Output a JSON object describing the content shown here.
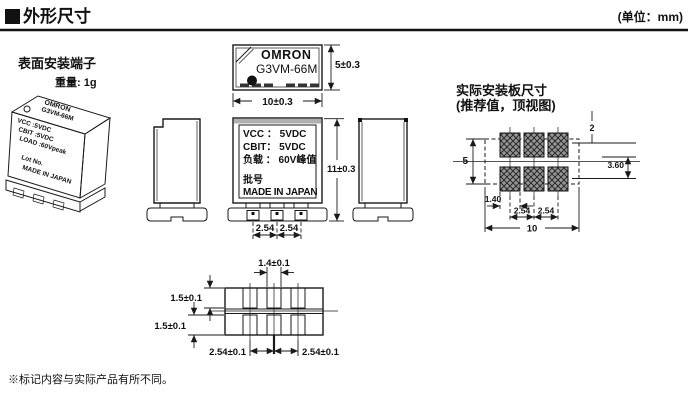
{
  "header": {
    "title": "外形尺寸",
    "unit": "(单位：mm)"
  },
  "labels": {
    "mount_type": "表面安装端子",
    "weight": "重量: 1g",
    "footnote": "※标记内容与实际产品有所不同。"
  },
  "iso_view": {
    "brand": "OMRON",
    "model": "G3VM-66M",
    "spec1": "VCC :5VDC",
    "spec2": "CBIT :5VDC",
    "spec3": "LOAD :60Vpeak",
    "lot": "Lot No.",
    "origin": "MADE IN JAPAN"
  },
  "top_view": {
    "brand": "OMRON",
    "model": "G3VM-66M",
    "dim_height": "5±0.3",
    "dim_width": "10±0.3"
  },
  "front_view": {
    "spec1": "VCC ： 5VDC",
    "spec2": "CBIT： 5VDC",
    "spec3": "负载 ： 60V峰值",
    "lot_label": "批号",
    "origin": "MADE IN JAPAN",
    "dim_height": "11±0.3",
    "dim_pitch_left": "2.54",
    "dim_pitch_right": "2.54"
  },
  "pcb_layout": {
    "title": "实际安装板尺寸",
    "subtitle": "(推荐值，顶视图)",
    "dim_pad_height": "2",
    "dim_row_gap": "3.60",
    "dim_outline_height": "5",
    "dim_pad_width": "1.40",
    "dim_pitch_left": "2.54",
    "dim_pitch_right": "2.54",
    "dim_outline_width": "10"
  },
  "bottom_view": {
    "dim_pin_width": "1.4±0.1",
    "dim_pin_top": "1.5±0.1",
    "dim_pin_bottom": "1.5±0.1",
    "dim_pitch_left": "2.54±0.1",
    "dim_pitch_right": "2.54±0.1"
  },
  "colors": {
    "line": "#1a1a1a",
    "pad_fill": "#969696",
    "background": "#ffffff"
  }
}
